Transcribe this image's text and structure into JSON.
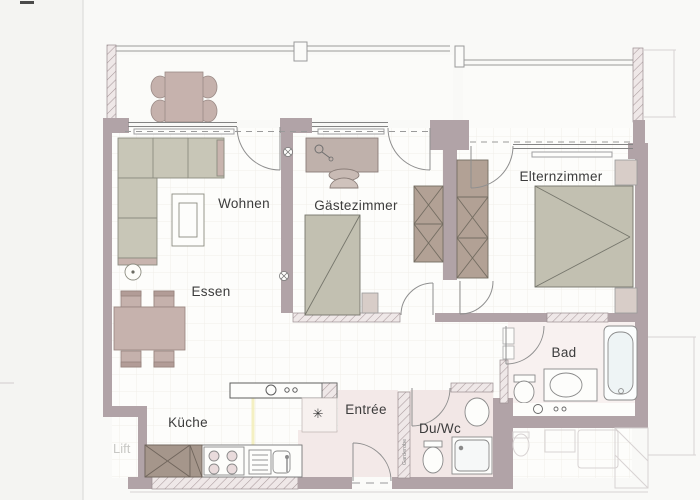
{
  "document": {
    "type": "floorplan-scan",
    "language": "de"
  },
  "labels": {
    "wohnen": "Wohnen",
    "gaestezimmer": "Gästezimmer",
    "elternzimmer": "Elternzimmer",
    "essen": "Essen",
    "kueche": "Küche",
    "entree": "Entrée",
    "duwc": "Du/Wc",
    "bad": "Bad",
    "lift": "Lift",
    "garderobe": "Garderobe",
    "fridge_symbol": "✳"
  },
  "rooms": [
    {
      "name": "Wohnen",
      "furniture": [
        "corner-sofa",
        "coffee-table",
        "floor-lamp"
      ]
    },
    {
      "name": "Essen",
      "furniture": [
        "dining-table",
        "four-chairs"
      ]
    },
    {
      "name": "Gästezimmer",
      "furniture": [
        "desk",
        "desk-chair",
        "desk-lamp",
        "single-bed",
        "wardrobe"
      ]
    },
    {
      "name": "Elternzimmer",
      "furniture": [
        "double-bed",
        "two-nightstands",
        "wardrobe"
      ]
    },
    {
      "name": "Küche",
      "furniture": [
        "counter-island",
        "hob",
        "sink",
        "stove",
        "tall-cabinet"
      ]
    },
    {
      "name": "Bad",
      "furniture": [
        "bathtub",
        "vanity-sink",
        "toilet"
      ]
    },
    {
      "name": "Du/Wc",
      "furniture": [
        "shower",
        "toilet",
        "sink"
      ]
    },
    {
      "name": "Entrée",
      "furniture": [
        "entrance-door",
        "garderobe-wall"
      ]
    },
    {
      "name": "Balkon",
      "furniture": [
        "outdoor-table",
        "four-chairs"
      ]
    }
  ],
  "colors": {
    "wall": "#b1a3a7",
    "wall_hatch_bg": "#efe8e8",
    "wall_hatch_line": "#a99a9d",
    "furniture_greige": "#c8c6b7",
    "furniture_rose": "#c5b1ac",
    "wardrobe": "#b2a195",
    "cabinet_dark": "#a5968b",
    "floor_pink": "#f3e9e8",
    "paper": "#f9f9f7",
    "line": "#8c8c80",
    "fixture_line": "#8a8a8a",
    "neighbor_faint": "#d8d3d3",
    "highlight_yellow": "#f3eeb4"
  }
}
